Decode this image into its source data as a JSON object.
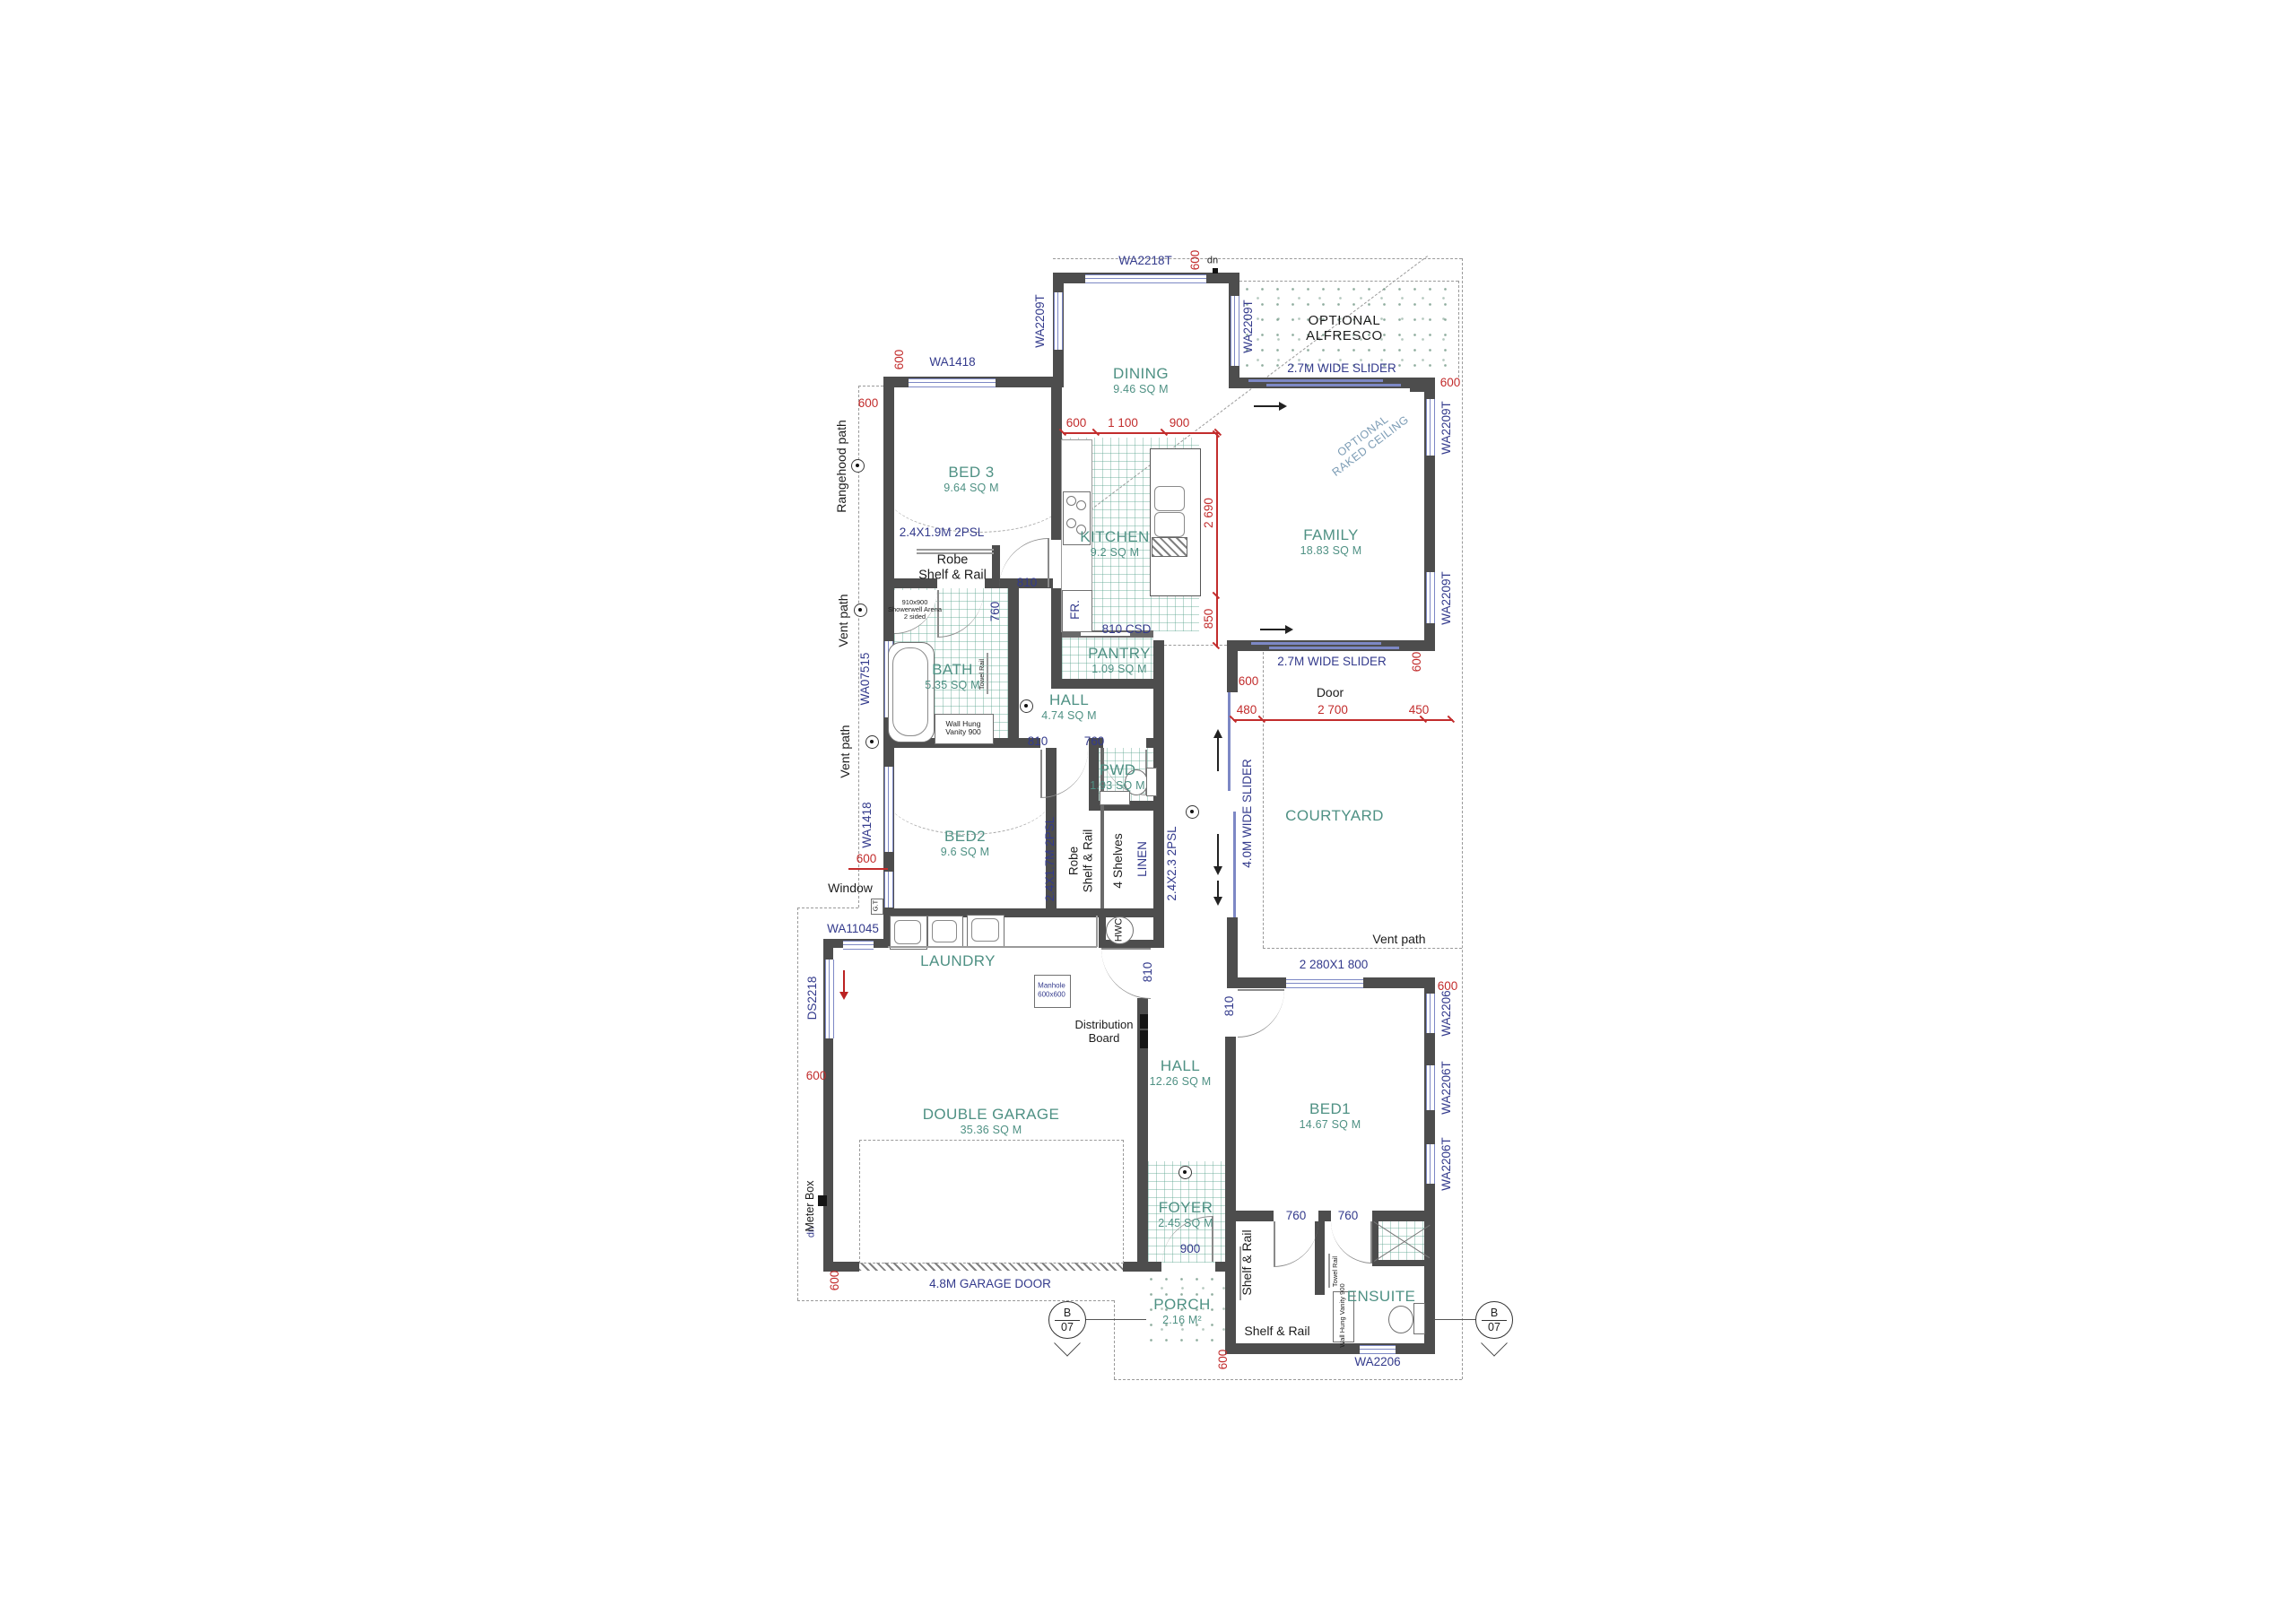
{
  "title": "Residential floor plan working drawing",
  "colors": {
    "wall": "#4d4d4d",
    "room_label": "#4f9184",
    "window_label": "#333a8c",
    "dimension": "#c22c2c",
    "annotation": "#1c1c1c",
    "tile_grid": "#5ca58f",
    "glazing": "#7d88c5"
  },
  "rooms": [
    {
      "name": "DINING",
      "area": "9.46 SQ M"
    },
    {
      "name": "FAMILY",
      "area": "18.83 SQ M"
    },
    {
      "name": "KITCHEN",
      "area": "9.2 SQ M"
    },
    {
      "name": "PANTRY",
      "area": "1.09 SQ M"
    },
    {
      "name": "BED 3",
      "area": "9.64 SQ M"
    },
    {
      "name": "BATH",
      "area": "5.35 SQ M"
    },
    {
      "name": "HALL",
      "area": "4.74 SQ M"
    },
    {
      "name": "PWD",
      "area": "1.93 SQ M"
    },
    {
      "name": "BED2",
      "area": "9.6 SQ M"
    },
    {
      "name": "COURTYARD",
      "area": ""
    },
    {
      "name": "LAUNDRY",
      "area": ""
    },
    {
      "name": "HALL",
      "area": "12.26 SQ M"
    },
    {
      "name": "DOUBLE GARAGE",
      "area": "35.36 SQ M"
    },
    {
      "name": "BED1",
      "area": "14.67 SQ M"
    },
    {
      "name": "FOYER",
      "area": "2.45 SQ M"
    },
    {
      "name": "PORCH",
      "area": "2.16 M²"
    },
    {
      "name": "ENSUITE",
      "area": ""
    }
  ],
  "windows": {
    "wa2218t": "WA2218T",
    "wa2209t": "WA2209T",
    "wa1418": "WA1418",
    "wa07515": "WA07515",
    "wa11045": "WA11045",
    "ds2218": "DS2218",
    "wa2206": "WA2206",
    "wa2206t": "WA2206T",
    "w2280": "2 280X1 800"
  },
  "doors_fittings": {
    "slider27": "2.7M WIDE SLIDER",
    "slider40": "4.0M WIDE SLIDER",
    "garage_door": "4.8M GARAGE DOOR",
    "d810": "810",
    "d760": "760",
    "d810csd": "810 CSD",
    "d900": "900",
    "linen": "LINEN",
    "psl19": "2.4X1.9M 2PSL",
    "psl17": "2.4X1.7M 2PSL",
    "psl23": "2.4X2.3 2PSL",
    "fr": "FR.",
    "dn": "dn",
    "hwc": "HWC",
    "gt": "G.T",
    "shelves4": "4 Shelves",
    "shelf_rail": "Shelf & Rail",
    "robe_line1": "Robe",
    "robe_line2": "Shelf & Rail"
  },
  "annotations": {
    "alfresco1": "OPTIONAL",
    "alfresco2": "ALFRESCO",
    "raked1": "OPTIONAL",
    "raked2": "RAKED CEILING",
    "door": "Door",
    "window": "Window",
    "rangehood": "Rangehood path",
    "vent": "Vent path",
    "meter": "Meter Box",
    "dist1": "Distribution",
    "dist2": "Board",
    "marker_top": "B",
    "marker_bottom": "07",
    "manhole1": "Manhole",
    "manhole2": "600x600",
    "shower1": "910x900",
    "shower2": "Showerwell Arena",
    "shower3": "2 sided",
    "vanity1": "Wall Hung",
    "vanity2": "Vanity 900",
    "vanity900": "Wall Hung Vanity 900",
    "towel": "Towel Rail"
  },
  "dimensions": {
    "d600": "600",
    "d1100": "1 100",
    "d900": "900",
    "d2690": "2 690",
    "d850": "850",
    "d480": "480",
    "d2700": "2 700",
    "d450": "450"
  }
}
